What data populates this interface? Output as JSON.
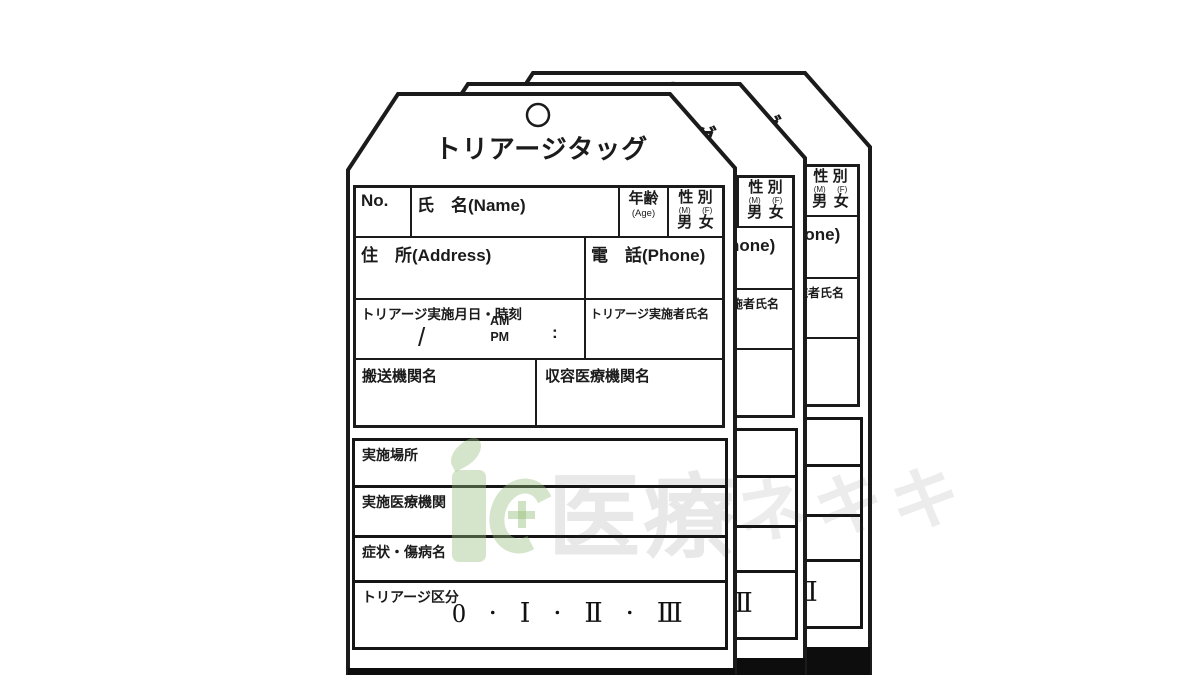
{
  "tag": {
    "title": "トリアージタッグ",
    "fields": {
      "no_label": "No.",
      "name_label": "氏　名(Name)",
      "age_label": "年齢",
      "age_sub": "(Age)",
      "sex_label": "性 別",
      "sex_sub_m": "(M)",
      "sex_sub_f": "(F)",
      "sex_male": "男",
      "sex_female": "女",
      "address_label": "住　所(Address)",
      "phone_label": "電　話(Phone)",
      "triage_datetime_label": "トリアージ実施月日・時刻",
      "slash": "/",
      "am_pm": "AM\nPM",
      "colon": ":",
      "examiner_label": "トリアージ実施者氏名",
      "carrier_label": "搬送機関名",
      "hospital_label": "収容医療機関名",
      "site_label": "実施場所",
      "institution_label": "実施医療機関",
      "symptoms_label": "症状・傷病名",
      "category_label": "トリアージ区分",
      "categories": [
        "0",
        "Ⅰ",
        "Ⅱ",
        "Ⅲ"
      ],
      "category_separator": "・"
    }
  },
  "stack": {
    "tag_count": 3
  },
  "watermark": {
    "text_main": "医療",
    "text_extra": [
      "ネ",
      "キ",
      "キ"
    ],
    "logo": "green-leaf-i-and-c-with-cross",
    "logo_color": "#96be7d"
  },
  "colors": {
    "background": "#ffffff",
    "line": "#1b1b1b",
    "bottom_bar": "#0d0d0d"
  }
}
